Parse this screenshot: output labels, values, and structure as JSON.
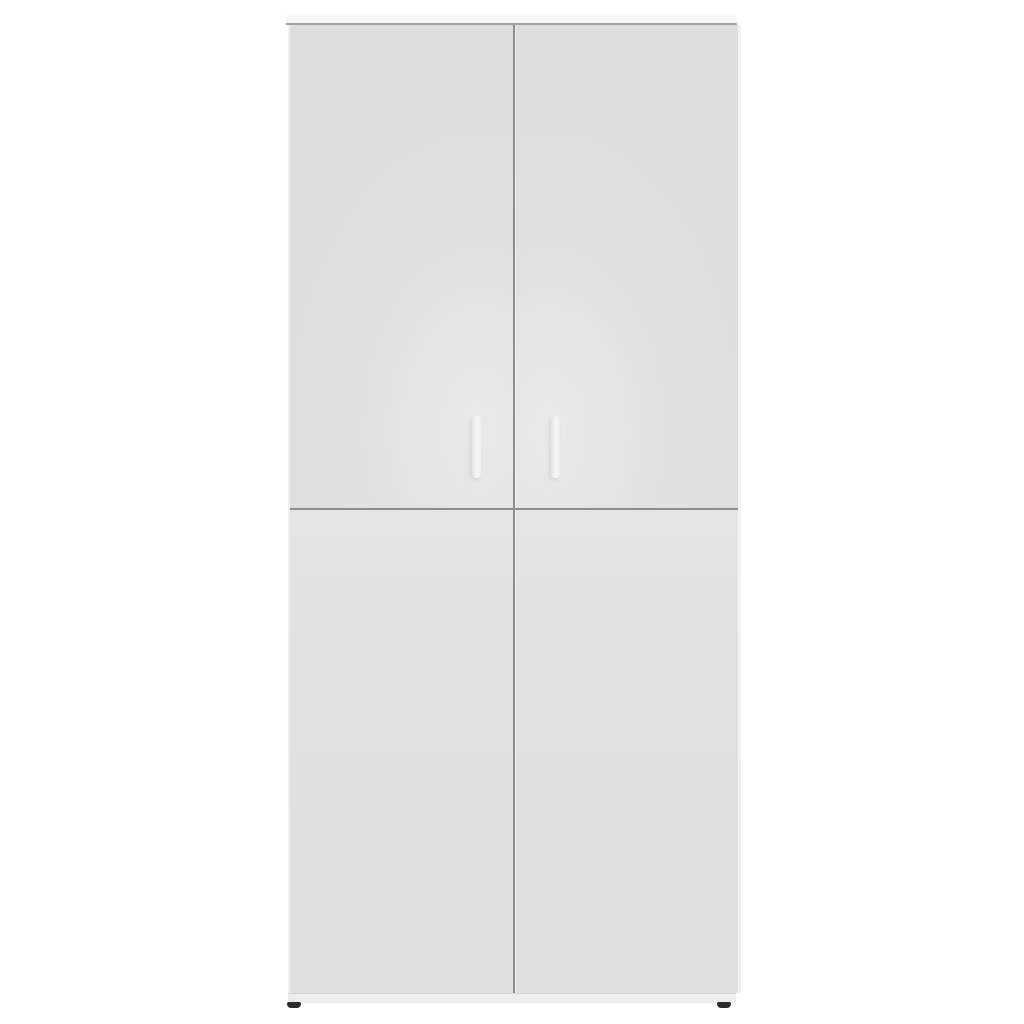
{
  "scene": {
    "type": "product-photo",
    "subject": "Tall white storage cabinet with four flat door panels, two vertical bar handles and dark feet, on a plain white background",
    "background_color": "#ffffff"
  },
  "colors": {
    "background": "#ffffff",
    "door_face": "#e1e1e1",
    "door_highlight": "#eaeaea",
    "door_shadow": "#dddddd",
    "top_panel": "#f2f2f2",
    "top_panel_edge": "#a2a2a2",
    "seam": "#8d8d8d",
    "plinth": "#ededed",
    "plinth_edge": "#d6d6d6",
    "handle": "#f8f8f8",
    "handle_edge": "#e3e3e3",
    "foot": "#2b2b2b"
  },
  "cabinet": {
    "door_count": 4,
    "handle_count": 2,
    "foot_count": 2,
    "part_names": [
      "top-panel",
      "door-top-left",
      "door-top-right",
      "door-bottom-left",
      "door-bottom-right",
      "vertical-seam",
      "horizontal-seam",
      "handle-left",
      "handle-right",
      "plinth",
      "foot-left",
      "foot-right"
    ]
  }
}
